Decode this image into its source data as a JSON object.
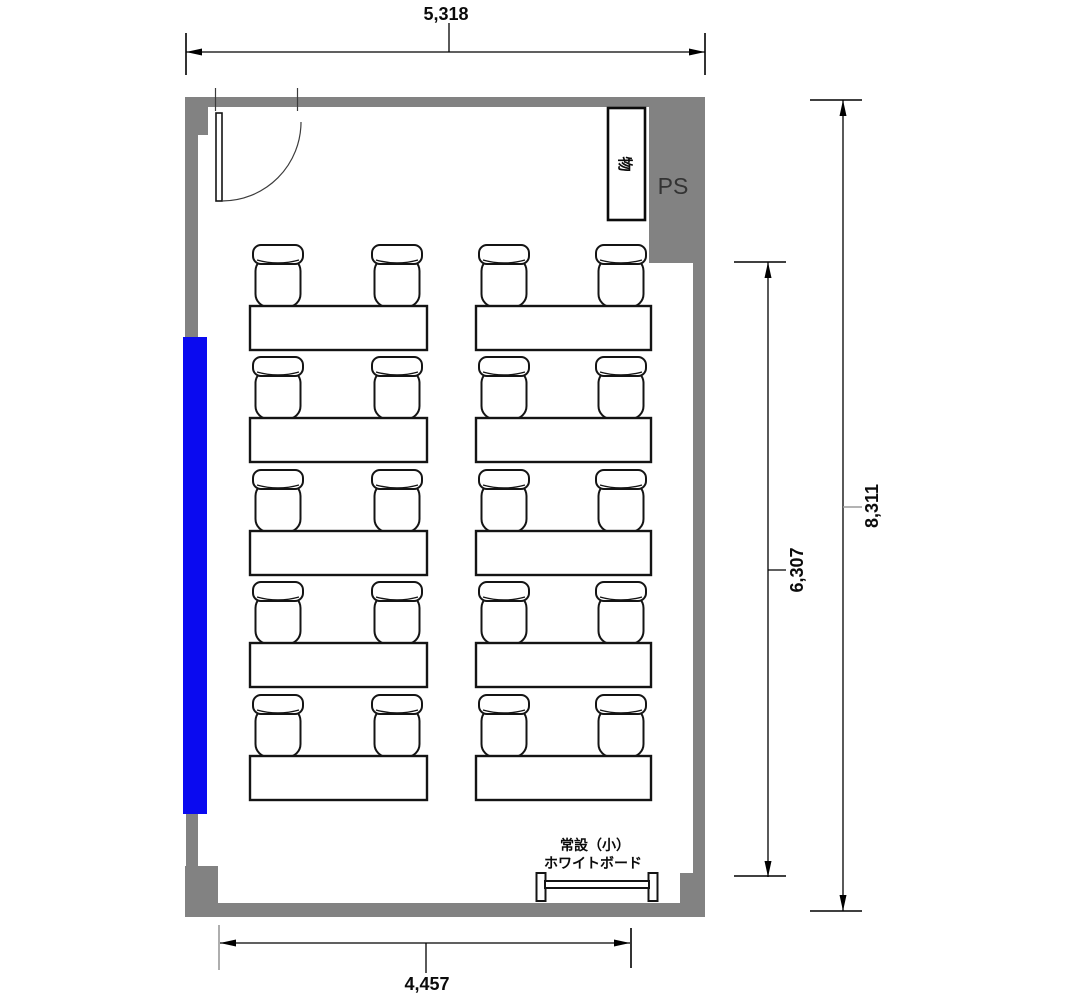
{
  "canvas": {
    "width": 1068,
    "height": 1000,
    "background": "#ffffff"
  },
  "colors": {
    "wall": "#828282",
    "window": "#0a0af0",
    "line": "#000000",
    "furniture": "#141414",
    "dim_gray": "#9a9a9a",
    "ps_text": "#333333"
  },
  "dimensions": {
    "top": "5,318",
    "bottom": "4,457",
    "right_outer": "8,311",
    "right_inner": "6,307"
  },
  "labels": {
    "pipe_space": "PS",
    "cabinet": "物",
    "whiteboard_note_line1": "常設（小）",
    "whiteboard_note_line2": "ホワイトボード"
  },
  "furniture": {
    "rows": 5,
    "columns": 2,
    "total_tables": 10,
    "chairs_per_table": 2,
    "total_chairs": 20,
    "table_row_y": [
      306,
      418,
      531,
      643,
      756
    ],
    "table_columns": [
      {
        "x": 250,
        "w": 177
      },
      {
        "x": 476,
        "w": 175
      }
    ],
    "table_h": 44,
    "chair": {
      "w": 50,
      "h": 62,
      "inset_left": 3,
      "inset_right": 5
    }
  }
}
